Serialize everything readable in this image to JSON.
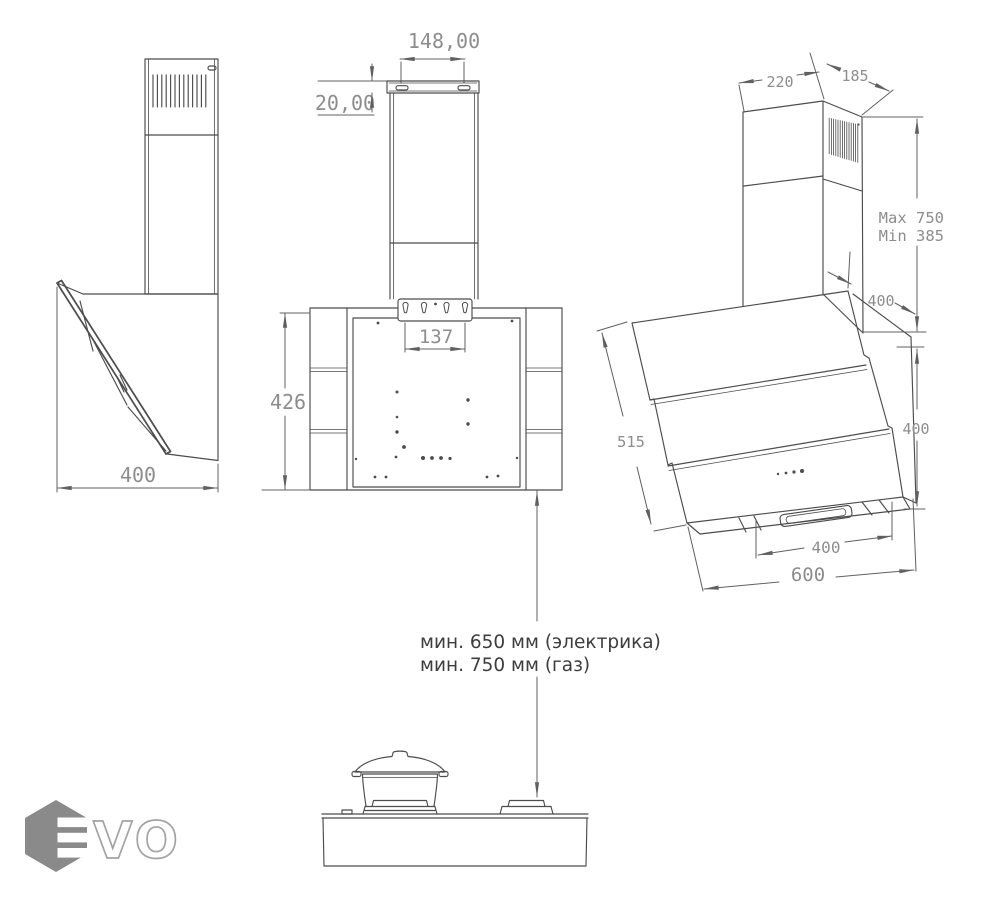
{
  "title": "Range hood dimensional drawing",
  "colors": {
    "background": "#ffffff",
    "outline": "#4c4c4c",
    "dimension_line": "#606060",
    "dimension_text": "#8d8d8d",
    "note_text": "#3d3d3d",
    "logo_gray": "#8a8a8a"
  },
  "drawing": {
    "side": {
      "width": "400"
    },
    "front": {
      "top_width": "148,00",
      "top_height": "20,00",
      "bracket_span": "137",
      "body_height": "426"
    },
    "persp": {
      "chimney_depth": "220",
      "chimney_width": "185",
      "height_max": "Max 750",
      "height_min": "Min 385",
      "top_depth": "400",
      "glass_length": "515",
      "body_height": "400",
      "outlet_width": "400",
      "total_width": "600"
    },
    "install": {
      "electric": "мин. 650 мм (электрика)",
      "gas": "мин. 750 мм (газ)"
    }
  },
  "logo": {
    "wordmark": "VO"
  }
}
